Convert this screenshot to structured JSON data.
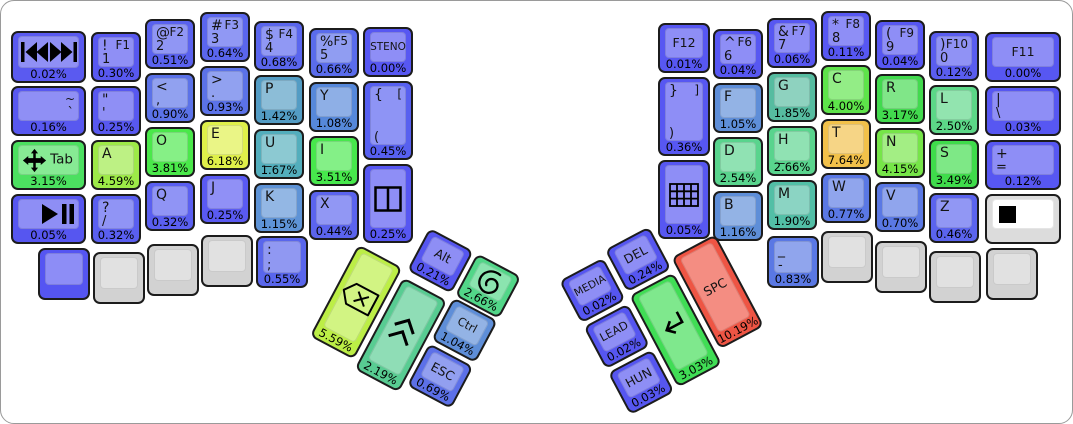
{
  "board": {
    "background": "#ffffff",
    "border_color": "#9a9a9a"
  },
  "chart_data": {
    "type": "heatmap",
    "title": "Keyboard key usage heatmap (percent of keystrokes)",
    "unit": "%",
    "items": [
      {
        "label": "SPC",
        "value": 10.19
      },
      {
        "label": "T",
        "value": 7.64
      },
      {
        "label": "E",
        "value": 6.18
      },
      {
        "label": "Backspace",
        "value": 5.59
      },
      {
        "label": "A",
        "value": 4.59
      },
      {
        "label": "N",
        "value": 4.15
      },
      {
        "label": "C",
        "value": 4.0
      },
      {
        "label": "O",
        "value": 3.81
      },
      {
        "label": "I",
        "value": 3.51
      },
      {
        "label": "S",
        "value": 3.49
      },
      {
        "label": "R",
        "value": 3.17
      },
      {
        "label": "Tab",
        "value": 3.15
      },
      {
        "label": "Enter",
        "value": 3.03
      },
      {
        "label": "H",
        "value": 2.66
      },
      {
        "label": "Super",
        "value": 2.66
      },
      {
        "label": "D",
        "value": 2.54
      },
      {
        "label": "L",
        "value": 2.5
      },
      {
        "label": "Shift",
        "value": 2.19
      },
      {
        "label": "M",
        "value": 1.9
      },
      {
        "label": "G",
        "value": 1.85
      },
      {
        "label": "U",
        "value": 1.67
      },
      {
        "label": "P",
        "value": 1.42
      },
      {
        "label": "B",
        "value": 1.16
      },
      {
        "label": "K",
        "value": 1.15
      },
      {
        "label": "Y",
        "value": 1.08
      },
      {
        "label": "F",
        "value": 1.05
      },
      {
        "label": "Ctrl",
        "value": 1.04
      },
      {
        "label": "> .",
        "value": 0.93
      },
      {
        "label": "< ,",
        "value": 0.9
      },
      {
        "label": "_ -",
        "value": 0.83
      },
      {
        "label": "W",
        "value": 0.77
      },
      {
        "label": "V",
        "value": 0.7
      },
      {
        "label": "ESC",
        "value": 0.69
      },
      {
        "label": "$ 4",
        "value": 0.68
      },
      {
        "label": "% 5",
        "value": 0.66
      },
      {
        "label": "# 3",
        "value": 0.64
      },
      {
        "label": ": ;",
        "value": 0.55
      },
      {
        "label": "@ 2",
        "value": 0.51
      },
      {
        "label": "Z",
        "value": 0.46
      },
      {
        "label": "{ [ (",
        "value": 0.45
      },
      {
        "label": "X",
        "value": 0.44
      },
      {
        "label": "} ] )",
        "value": 0.36
      },
      {
        "label": "? /",
        "value": 0.32
      },
      {
        "label": "Q",
        "value": 0.32
      },
      {
        "label": "! 1",
        "value": 0.3
      },
      {
        "label": "J",
        "value": 0.25
      },
      {
        "label": "quote",
        "value": 0.25
      },
      {
        "label": "split-window",
        "value": 0.25
      },
      {
        "label": "DEL",
        "value": 0.24
      },
      {
        "label": "Alt",
        "value": 0.21
      },
      {
        "label": "~ `",
        "value": 0.16
      },
      {
        "label": ") 0",
        "value": 0.12
      },
      {
        "label": "+ =",
        "value": 0.12
      },
      {
        "label": "* 8",
        "value": 0.11
      },
      {
        "label": "& 7",
        "value": 0.06
      },
      {
        "label": "play-pause",
        "value": 0.05
      },
      {
        "label": "keypad",
        "value": 0.05
      },
      {
        "label": "^ 6",
        "value": 0.04
      },
      {
        "label": "( 9",
        "value": 0.04
      },
      {
        "label": "HUN",
        "value": 0.03
      },
      {
        "label": "| \\",
        "value": 0.03
      },
      {
        "label": "MEDIA",
        "value": 0.02
      },
      {
        "label": "LEAD",
        "value": 0.02
      },
      {
        "label": "prev-next-track",
        "value": 0.02
      },
      {
        "label": "F12",
        "value": 0.01
      },
      {
        "label": "STENO",
        "value": 0.0
      },
      {
        "label": "F11",
        "value": 0.0
      }
    ]
  },
  "keys": [
    {
      "name": "media-prev-next",
      "x": 10,
      "y": 30,
      "w": 75,
      "h": 52,
      "color": "#5a5af0",
      "icon": "prev-next-track-icon",
      "pct": "0.02%"
    },
    {
      "name": "1",
      "x": 90,
      "y": 31,
      "color": "#5858f0",
      "labels": {
        "tl": "!",
        "tr": "F1",
        "bl": "1"
      },
      "pct": "0.30%"
    },
    {
      "name": "2",
      "x": 144,
      "y": 18,
      "color": "#5a62ee",
      "labels": {
        "tl": "@",
        "tr": "F2",
        "bl": "2"
      },
      "pct": "0.51%"
    },
    {
      "name": "3",
      "x": 199,
      "y": 11,
      "color": "#5a66ee",
      "labels": {
        "tl": "#",
        "tr": "F3",
        "bl": "3"
      },
      "pct": "0.64%"
    },
    {
      "name": "4",
      "x": 253,
      "y": 20,
      "color": "#5a66ee",
      "labels": {
        "tl": "$",
        "tr": "F4",
        "bl": "4"
      },
      "pct": "0.68%"
    },
    {
      "name": "5",
      "x": 308,
      "y": 27,
      "color": "#5a6cec",
      "labels": {
        "tl": "%",
        "tr": "F5",
        "bl": "5"
      },
      "pct": "0.66%"
    },
    {
      "name": "steno",
      "x": 362,
      "y": 26,
      "color": "#5757f2",
      "center": "STENO",
      "pct": "0.00%"
    },
    {
      "name": "grave-tilde",
      "x": 10,
      "y": 85,
      "w": 75,
      "color": "#5858f0",
      "labels": {
        "tr": "~",
        "br": "`"
      },
      "pct": "0.16%"
    },
    {
      "name": "quote",
      "x": 90,
      "y": 85,
      "color": "#5858f0",
      "labels": {
        "tl": "\"",
        "bl": "'"
      },
      "pct": "0.25%"
    },
    {
      "name": "comma",
      "x": 144,
      "y": 72,
      "color": "#5b72e8",
      "labels": {
        "tl": "<",
        "bl": ","
      },
      "pct": "0.90%"
    },
    {
      "name": "period",
      "x": 199,
      "y": 65,
      "color": "#5b72e8",
      "labels": {
        "tl": ">",
        "bl": "."
      },
      "pct": "0.93%"
    },
    {
      "name": "p",
      "x": 253,
      "y": 74,
      "color": "#539cc4",
      "labels": {
        "tl": "P"
      },
      "pct": "1.42%"
    },
    {
      "name": "y",
      "x": 308,
      "y": 81,
      "color": "#5688da",
      "labels": {
        "tl": "Y"
      },
      "pct": "1.08%"
    },
    {
      "name": "bracket-open",
      "x": 362,
      "y": 80,
      "h": 79,
      "color": "#5760f0",
      "labels": {
        "tl": "{",
        "tr": "[",
        "bl": "("
      },
      "pct": "0.45%"
    },
    {
      "name": "tab",
      "x": 10,
      "y": 139,
      "w": 75,
      "color": "#4ce060",
      "icon": "move-icon",
      "text_right": "Tab",
      "pct": "3.15%"
    },
    {
      "name": "a",
      "x": 90,
      "y": 139,
      "color": "#9dea48",
      "labels": {
        "tl": "A"
      },
      "pct": "4.59%"
    },
    {
      "name": "o",
      "x": 144,
      "y": 126,
      "color": "#4ae84a",
      "labels": {
        "tl": "O"
      },
      "pct": "3.81%"
    },
    {
      "name": "e",
      "x": 199,
      "y": 119,
      "color": "#dff04a",
      "labels": {
        "tl": "E"
      },
      "pct": "6.18%"
    },
    {
      "name": "u",
      "x": 253,
      "y": 128,
      "color": "#53aebc",
      "labels": {
        "tl": "U",
        "ml": "_"
      },
      "pct": "1.67%"
    },
    {
      "name": "i",
      "x": 308,
      "y": 135,
      "color": "#47e84c",
      "labels": {
        "tl": "I"
      },
      "pct": "3.51%"
    },
    {
      "name": "media-play-pause",
      "x": 10,
      "y": 193,
      "w": 75,
      "color": "#5656f0",
      "icon": "play-pause-icon",
      "pct": "0.05%"
    },
    {
      "name": "slash",
      "x": 90,
      "y": 193,
      "color": "#5a5ff0",
      "labels": {
        "tl": "?",
        "bl": "/"
      },
      "pct": "0.32%"
    },
    {
      "name": "q",
      "x": 144,
      "y": 180,
      "color": "#5a5ff0",
      "labels": {
        "tl": "Q"
      },
      "pct": "0.32%"
    },
    {
      "name": "j",
      "x": 199,
      "y": 173,
      "color": "#5a5af2",
      "labels": {
        "tl": "J"
      },
      "pct": "0.25%"
    },
    {
      "name": "k",
      "x": 253,
      "y": 182,
      "color": "#5e93d6",
      "labels": {
        "tl": "K"
      },
      "pct": "1.15%"
    },
    {
      "name": "x",
      "x": 308,
      "y": 189,
      "color": "#5b64ee",
      "labels": {
        "tl": "X"
      },
      "pct": "0.44%"
    },
    {
      "name": "split-window",
      "x": 362,
      "y": 163,
      "h": 79,
      "color": "#5757f2",
      "icon": "split-window-icon",
      "pct": "0.25%"
    },
    {
      "name": "blank-left",
      "x": 37,
      "y": 247,
      "w": 52,
      "h": 52,
      "color": "#5555f2"
    },
    {
      "name": "blank-gray-l1",
      "x": 92,
      "y": 251,
      "w": 52,
      "h": 52,
      "color": "#d2d2d2"
    },
    {
      "name": "blank-gray-l2",
      "x": 146,
      "y": 243,
      "w": 52,
      "h": 52,
      "color": "#d2d2d2"
    },
    {
      "name": "blank-gray-l3",
      "x": 200,
      "y": 234,
      "w": 52,
      "h": 52,
      "color": "#d2d2d2"
    },
    {
      "name": "semicolon",
      "x": 255,
      "y": 235,
      "w": 52,
      "h": 52,
      "color": "#5966ec",
      "labels": {
        "tl": ":",
        "bl": ";"
      },
      "pct": "0.55%"
    },
    {
      "name": "f12",
      "x": 657,
      "y": 22,
      "w": 52,
      "color": "#5757f2",
      "center": "F12",
      "pct": "0.01%"
    },
    {
      "name": "6",
      "x": 712,
      "y": 28,
      "color": "#5757f2",
      "labels": {
        "tl": "^",
        "tr": "F6",
        "bl": "6"
      },
      "pct": "0.04%"
    },
    {
      "name": "7",
      "x": 766,
      "y": 17,
      "color": "#5757f2",
      "labels": {
        "tl": "&",
        "tr": "F7",
        "bl": "7"
      },
      "pct": "0.06%"
    },
    {
      "name": "8",
      "x": 820,
      "y": 10,
      "color": "#5757f2",
      "labels": {
        "tl": "*",
        "tr": "F8",
        "bl": "8"
      },
      "pct": "0.11%"
    },
    {
      "name": "9",
      "x": 874,
      "y": 19,
      "color": "#5757f2",
      "labels": {
        "tl": "(",
        "tr": "F9",
        "bl": "9"
      },
      "pct": "0.04%"
    },
    {
      "name": "0",
      "x": 928,
      "y": 30,
      "color": "#5a5df0",
      "labels": {
        "tl": ")",
        "tr": "F10",
        "bl": "0"
      },
      "pct": "0.12%"
    },
    {
      "name": "f11",
      "x": 984,
      "y": 31,
      "w": 76,
      "color": "#5757f2",
      "center": "F11",
      "pct": "0.00%"
    },
    {
      "name": "bracket-close",
      "x": 657,
      "y": 76,
      "w": 52,
      "h": 79,
      "color": "#5757f2",
      "labels": {
        "tl": "}",
        "tr": "]",
        "bl": ")"
      },
      "pct": "0.36%"
    },
    {
      "name": "f",
      "x": 712,
      "y": 82,
      "color": "#5e8ed8",
      "labels": {
        "tl": "F"
      },
      "pct": "1.05%"
    },
    {
      "name": "g",
      "x": 766,
      "y": 71,
      "color": "#56bca0",
      "labels": {
        "tl": "G"
      },
      "pct": "1.85%"
    },
    {
      "name": "c",
      "x": 820,
      "y": 64,
      "color": "#5ee44a",
      "labels": {
        "tl": "C"
      },
      "pct": "4.00%"
    },
    {
      "name": "r",
      "x": 874,
      "y": 73,
      "color": "#42da4e",
      "labels": {
        "tl": "R"
      },
      "pct": "3.17%"
    },
    {
      "name": "l",
      "x": 928,
      "y": 84,
      "color": "#5cd787",
      "labels": {
        "tl": "L"
      },
      "pct": "2.50%"
    },
    {
      "name": "pipe-backslash",
      "x": 984,
      "y": 85,
      "w": 76,
      "color": "#5757f2",
      "labels": {
        "tl": "|",
        "bl": "\\"
      },
      "pct": "0.03%"
    },
    {
      "name": "d",
      "x": 712,
      "y": 136,
      "color": "#59d48d",
      "labels": {
        "tl": "D"
      },
      "pct": "2.54%"
    },
    {
      "name": "h",
      "x": 766,
      "y": 125,
      "color": "#59d48d",
      "labels": {
        "tl": "H",
        "ml": "_"
      },
      "pct": "2.66%"
    },
    {
      "name": "t",
      "x": 820,
      "y": 118,
      "color": "#f2c14a",
      "labels": {
        "tl": "T"
      },
      "pct": "7.64%"
    },
    {
      "name": "n",
      "x": 874,
      "y": 127,
      "color": "#76e548",
      "labels": {
        "tl": "N"
      },
      "pct": "4.15%"
    },
    {
      "name": "s",
      "x": 928,
      "y": 138,
      "color": "#3fdc4b",
      "labels": {
        "tl": "S"
      },
      "pct": "3.49%"
    },
    {
      "name": "plus-equals",
      "x": 984,
      "y": 139,
      "w": 76,
      "color": "#5757f2",
      "labels": {
        "tl": "+",
        "bl": "="
      },
      "pct": "0.12%"
    },
    {
      "name": "keypad",
      "x": 657,
      "y": 159,
      "w": 52,
      "h": 79,
      "color": "#5757f2",
      "icon": "keypad-icon",
      "pct": "0.05%"
    },
    {
      "name": "b",
      "x": 712,
      "y": 190,
      "color": "#5e8ed8",
      "labels": {
        "tl": "B"
      },
      "pct": "1.16%"
    },
    {
      "name": "m",
      "x": 766,
      "y": 179,
      "color": "#52bfa6",
      "labels": {
        "tl": "M"
      },
      "pct": "1.90%"
    },
    {
      "name": "w",
      "x": 820,
      "y": 172,
      "color": "#5a78e4",
      "labels": {
        "tl": "W"
      },
      "pct": "0.77%"
    },
    {
      "name": "v",
      "x": 874,
      "y": 181,
      "color": "#5a78e4",
      "labels": {
        "tl": "V"
      },
      "pct": "0.70%"
    },
    {
      "name": "z",
      "x": 928,
      "y": 192,
      "color": "#5b64ee",
      "labels": {
        "tl": "Z"
      },
      "pct": "0.46%"
    },
    {
      "name": "legend-swatch",
      "x": 984,
      "y": 193,
      "w": 76,
      "color": "#dcdcdc",
      "cap": "#ffffff",
      "icon": "black-square-icon"
    },
    {
      "name": "underscore-dash",
      "x": 766,
      "y": 235,
      "w": 52,
      "h": 52,
      "color": "#5a78e4",
      "labels": {
        "tl": "_",
        "bl": "-"
      },
      "pct": "0.83%"
    },
    {
      "name": "blank-gray-r1",
      "x": 820,
      "y": 230,
      "w": 52,
      "h": 52,
      "color": "#d2d2d2"
    },
    {
      "name": "blank-gray-r2",
      "x": 874,
      "y": 240,
      "w": 52,
      "h": 52,
      "color": "#d2d2d2"
    },
    {
      "name": "blank-gray-r3",
      "x": 928,
      "y": 250,
      "w": 52,
      "h": 52,
      "color": "#d2d2d2"
    },
    {
      "name": "blank-gray-r4",
      "x": 985,
      "y": 247,
      "w": 52,
      "h": 52,
      "color": "#d2d2d2"
    }
  ],
  "clusters": {
    "left": {
      "x": 380,
      "y": 201,
      "angle": 28,
      "keys": [
        {
          "name": "alt",
          "x": 55,
          "y": 0,
          "w": 50,
          "h": 48,
          "color": "#5656f0",
          "center": "Alt",
          "pct": "0.21%"
        },
        {
          "name": "super",
          "x": 109,
          "y": 0,
          "w": 50,
          "h": 48,
          "color": "#52d688",
          "icon": "spiral-icon",
          "pct": "2.66%"
        },
        {
          "name": "backspace",
          "x": 0,
          "y": 48,
          "w": 50,
          "h": 104,
          "color": "#bcee46",
          "icon": "backspace-icon",
          "pct": "5.59%"
        },
        {
          "name": "shift",
          "x": 55,
          "y": 56,
          "w": 50,
          "h": 104,
          "color": "#58cc92",
          "icon": "shift-icon",
          "pct": "2.19%"
        },
        {
          "name": "ctrl",
          "x": 109,
          "y": 50,
          "w": 50,
          "h": 48,
          "color": "#5e8ed8",
          "center": "Ctrl",
          "pct": "1.04%"
        },
        {
          "name": "esc",
          "x": 109,
          "y": 102,
          "w": 50,
          "h": 48,
          "color": "#5c70e8",
          "center": "ESC",
          "pct": "0.69%"
        }
      ]
    },
    "right": {
      "x": 558,
      "y": 280,
      "angle": -28,
      "keys": [
        {
          "name": "media",
          "x": 0,
          "y": 0,
          "w": 50,
          "h": 48,
          "color": "#5656f0",
          "center": "MEDIA",
          "pct": "0.02%"
        },
        {
          "name": "del",
          "x": 55,
          "y": -6,
          "w": 50,
          "h": 48,
          "color": "#5656f0",
          "center": "DEL",
          "pct": "0.24%"
        },
        {
          "name": "lead",
          "x": 0,
          "y": 52,
          "w": 50,
          "h": 48,
          "color": "#5656f0",
          "center": "LEAD",
          "pct": "0.02%"
        },
        {
          "name": "hun",
          "x": 0,
          "y": 104,
          "w": 50,
          "h": 48,
          "color": "#5656f0",
          "center": "HUN",
          "pct": "0.03%"
        },
        {
          "name": "enter",
          "x": 55,
          "y": 46,
          "w": 50,
          "h": 104,
          "color": "#40dd55",
          "icon": "enter-icon",
          "pct": "3.03%"
        },
        {
          "name": "space",
          "x": 110,
          "y": 32,
          "w": 50,
          "h": 104,
          "color": "#ee5544",
          "center": "SPC",
          "pct": "10.19%"
        }
      ]
    }
  }
}
